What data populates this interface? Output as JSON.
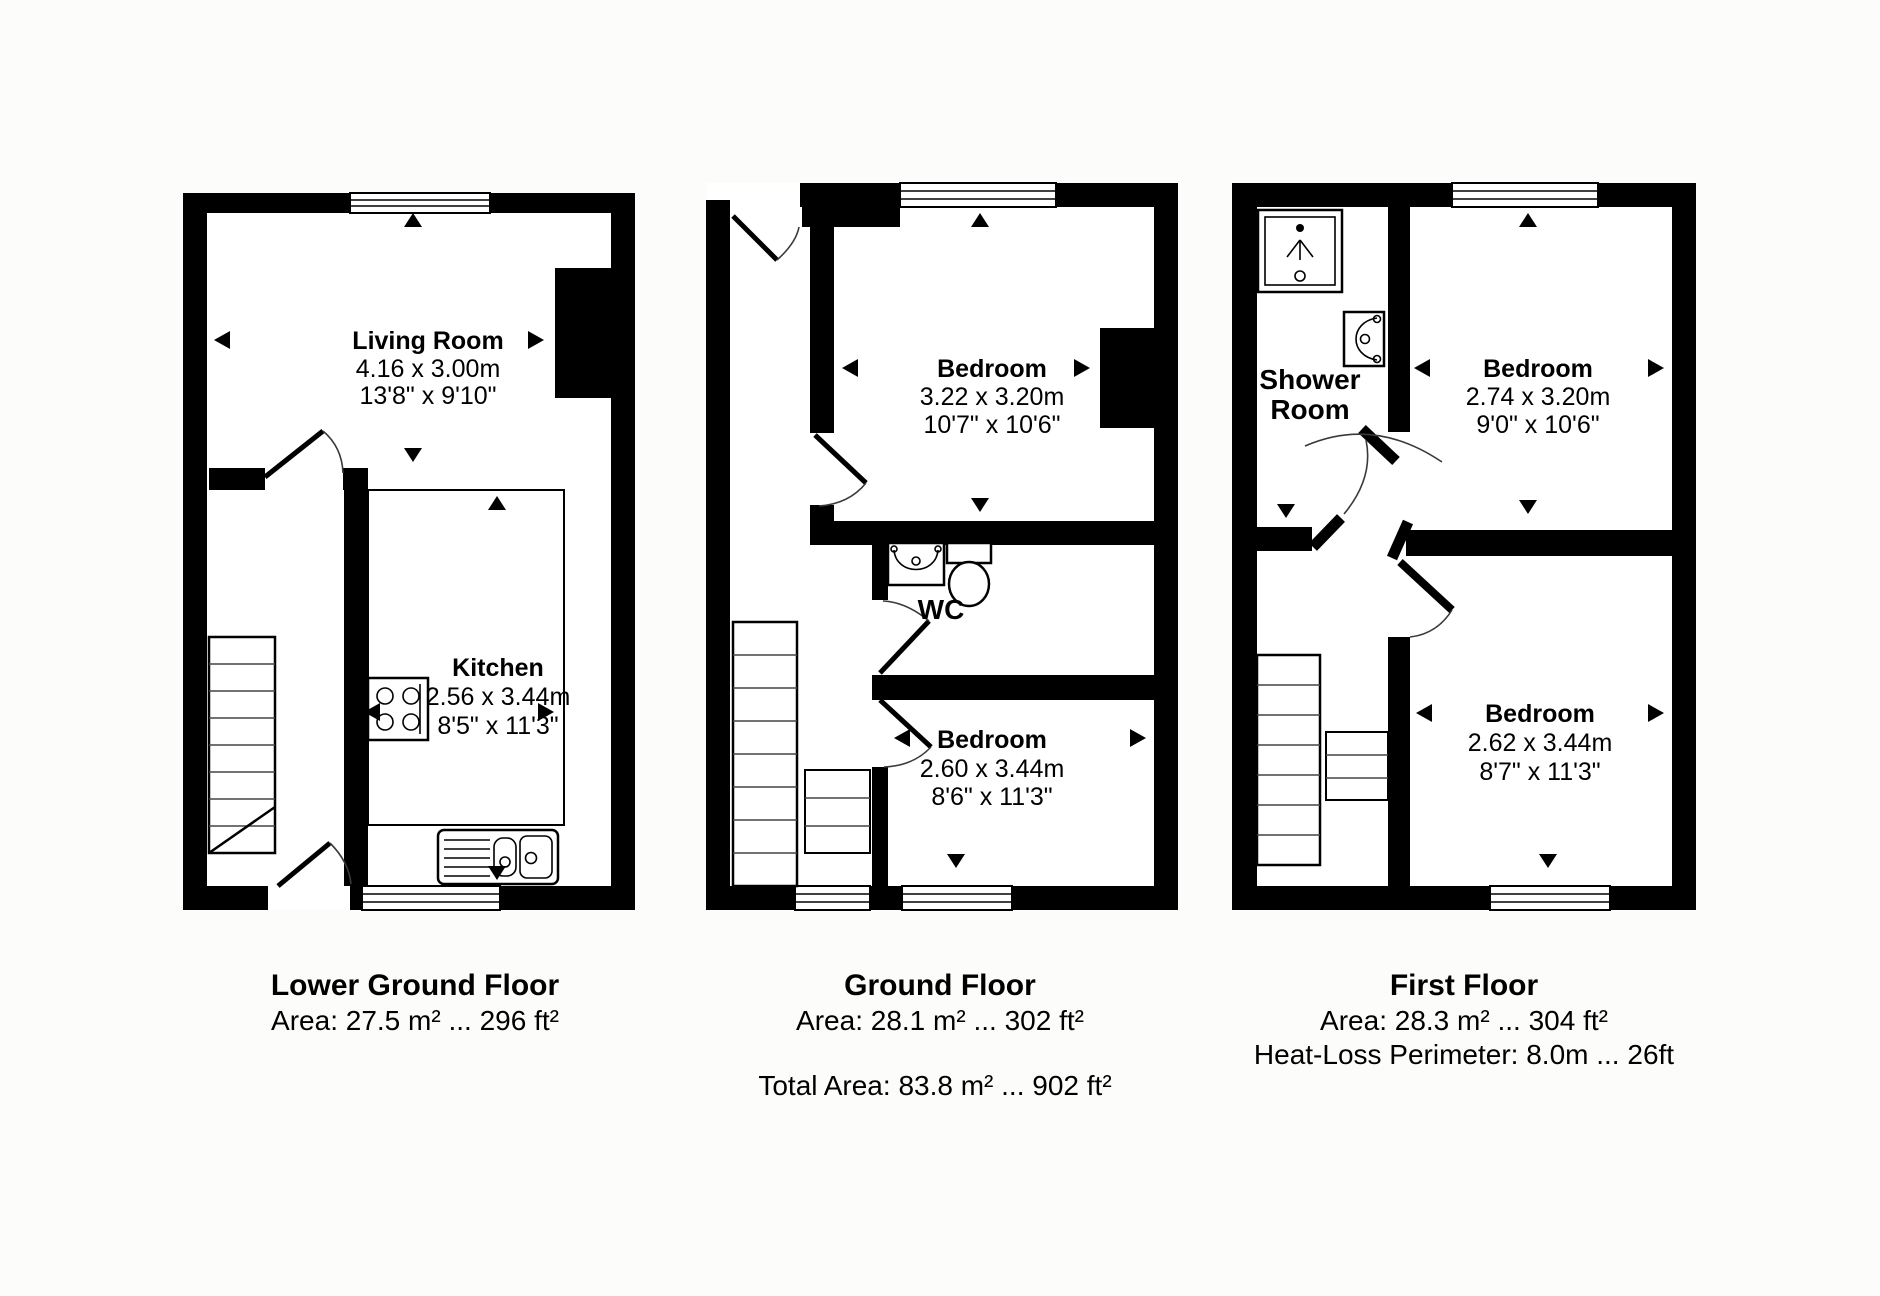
{
  "colors": {
    "wall": "#000000",
    "background": "#fcfcfb",
    "floor": "#ffffff"
  },
  "floors": {
    "lower": {
      "caption_title": "Lower Ground Floor",
      "caption_area": "Area: 27.5 m² ... 296 ft²",
      "living": {
        "name": "Living Room",
        "metric": "4.16 x 3.00m",
        "imperial": "13'8\" x 9'10\""
      },
      "kitchen": {
        "name": "Kitchen",
        "metric": "2.56 x 3.44m",
        "imperial": "8'5\" x 11'3\""
      }
    },
    "ground": {
      "caption_title": "Ground Floor",
      "caption_area": "Area: 28.1 m² ... 302 ft²",
      "bedroom1": {
        "name": "Bedroom",
        "metric": "3.22 x 3.20m",
        "imperial": "10'7\" x 10'6\""
      },
      "wc": {
        "name": "WC"
      },
      "bedroom2": {
        "name": "Bedroom",
        "metric": "2.60 x 3.44m",
        "imperial": "8'6\" x 11'3\""
      }
    },
    "first": {
      "caption_title": "First Floor",
      "caption_area": "Area: 28.3 m² ... 304 ft²",
      "caption_perimeter": "Heat-Loss Perimeter: 8.0m ... 26ft",
      "shower": {
        "line1": "Shower",
        "line2": "Room"
      },
      "bedroom1": {
        "name": "Bedroom",
        "metric": "2.74 x 3.20m",
        "imperial": "9'0\" x 10'6\""
      },
      "bedroom2": {
        "name": "Bedroom",
        "metric": "2.62 x 3.44m",
        "imperial": "8'7\" x 11'3\""
      }
    },
    "total_area": "Total Area: 83.8 m² ... 902 ft²"
  }
}
